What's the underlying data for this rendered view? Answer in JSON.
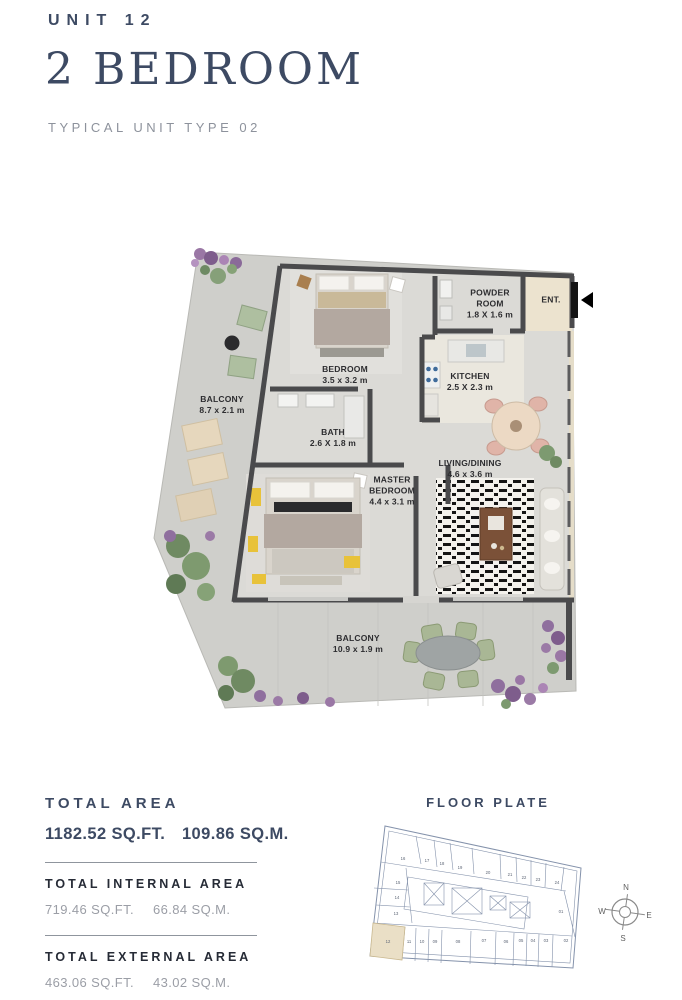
{
  "header": {
    "unit_label": "UNIT 12",
    "title": "2 BEDROOM",
    "subtitle": "TYPICAL UNIT TYPE 02"
  },
  "floor_plan": {
    "entrance_label": "ENT.",
    "rooms": [
      {
        "name": "BALCONY",
        "dims": "8.7 x 2.1 m"
      },
      {
        "name": "BEDROOM",
        "dims": "3.5 x 3.2 m"
      },
      {
        "name": "POWDER ROOM",
        "dims": "1.8 X 1.6 m"
      },
      {
        "name": "KITCHEN",
        "dims": "2.5 X 2.3 m"
      },
      {
        "name": "BATH",
        "dims": "2.6 X 1.8 m"
      },
      {
        "name": "MASTER BEDROOM",
        "dims": "4.4 x 3.1 m"
      },
      {
        "name": "LIVING/DINING",
        "dims": "4.6 x 3.6 m"
      },
      {
        "name": "BALCONY",
        "dims": "10.9 x 1.9 m"
      }
    ]
  },
  "areas": {
    "total": {
      "label": "TOTAL AREA",
      "sqft": "1182.52 SQ.FT.",
      "sqm": "109.86 SQ.M."
    },
    "internal": {
      "label": "TOTAL INTERNAL AREA",
      "sqft": "719.46 SQ.FT.",
      "sqm": "66.84 SQ.M."
    },
    "external": {
      "label": "TOTAL EXTERNAL AREA",
      "sqft": "463.06 SQ.FT.",
      "sqm": "43.02 SQ.M."
    }
  },
  "floor_plate": {
    "title": "FLOOR PLATE",
    "highlighted_unit": "12",
    "units": [
      "16",
      "17",
      "18",
      "19",
      "20",
      "21",
      "22",
      "23",
      "24",
      "15",
      "14",
      "13",
      "12",
      "11",
      "10",
      "09",
      "08",
      "07",
      "06",
      "05",
      "04",
      "03",
      "02",
      "01"
    ]
  },
  "compass": {
    "north": "N",
    "east": "E",
    "south": "S",
    "west": "W"
  },
  "colors": {
    "navy": "#3d4a63",
    "muted_gray": "#8d929c",
    "wall": "#4a4a4c",
    "plate_line": "#8492ab",
    "highlight_fill": "#eadfc6"
  }
}
